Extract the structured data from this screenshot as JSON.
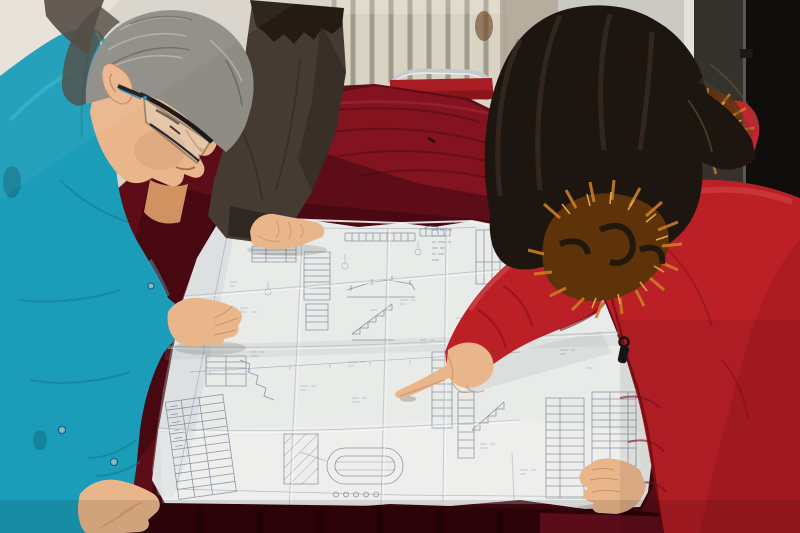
{
  "meta": {
    "alt": "Photograph: two workers leaning over a large folded engineering blueprint spread on a table covered with dark red velvet, in a room with a radiator and a dark doorway",
    "visible_text": []
  },
  "scene": {
    "background": {
      "wall": "plaster wall",
      "radiator": "white radiator with vertical fins",
      "doorway": "dark open doorway at right",
      "chair": "red folding chair with metal frame behind table"
    },
    "table": {
      "cover": "dark red velvet table cloth",
      "document": "large unfolded technical blueprint with construction detail drawings and schedule tables"
    },
    "people": [
      {
        "id": "engineer-left",
        "desc": "gray-haired man with glasses in a teal work jacket leaning over the drawing with both hands on it"
      },
      {
        "id": "bystander-top",
        "desc": "person in a dark jacket resting one hand on the top edge of the drawing"
      },
      {
        "id": "woman-right",
        "desc": "woman with long dark hair in a red down coat with orange fur-trimmed hood pointing at the drawing"
      }
    ]
  },
  "palette": {
    "wall": "#d8d4cb",
    "wall_light": "#e6e2da",
    "radiator_fin": "#d9d3c3",
    "radiator_gap": "#8f897c",
    "side_wall": "#b2a89a",
    "stain_brown": "#6e4a28",
    "door_panel": "#cbc9c4",
    "door_edge": "#e3e1db",
    "doorway_dark": "#35312c",
    "doorway_black": "#0f0d0c",
    "doorway_line": "#5c5750",
    "chair_red": "#a81d23",
    "chair_metal": "#c6cbce",
    "cloth_mid": "#5c0d18",
    "cloth_bright": "#8c1522",
    "cloth_dark": "#3c060e",
    "cloth_front": "#300409",
    "cloth_corner": "#c23848",
    "paper": "#e9ebe8",
    "paper_shadow": "#b9bec4",
    "ink": "#6d7890",
    "jacket_teal": "#1b9cb8",
    "jacket_dark": "#11768e",
    "jacket_light": "#45c4da",
    "collar_piping": "#c2ebf2",
    "bystander_coat": "#453b32",
    "bystander_dark": "#2f2822",
    "hair_gray": "#8e8c85",
    "hair_gray_dark": "#4c443b",
    "skin": "#e9b68c",
    "skin_shadow": "#c08457",
    "woman_hair": "#1c1510",
    "woman_hair_light": "#54422f",
    "fur_orange": "#c97d24",
    "fur_dark": "#5f3309",
    "fur_light": "#eaaf4d",
    "hood_red": "#c2252f",
    "coat_red": "#bb2026",
    "coat_red_dark": "#8a1016",
    "coat_red_deep": "#660a0f",
    "coat_red_light": "#d95352",
    "zipper_black": "#17171a",
    "glasses_black": "#1a1a1e",
    "glasses_blue": "#2b85b5"
  }
}
